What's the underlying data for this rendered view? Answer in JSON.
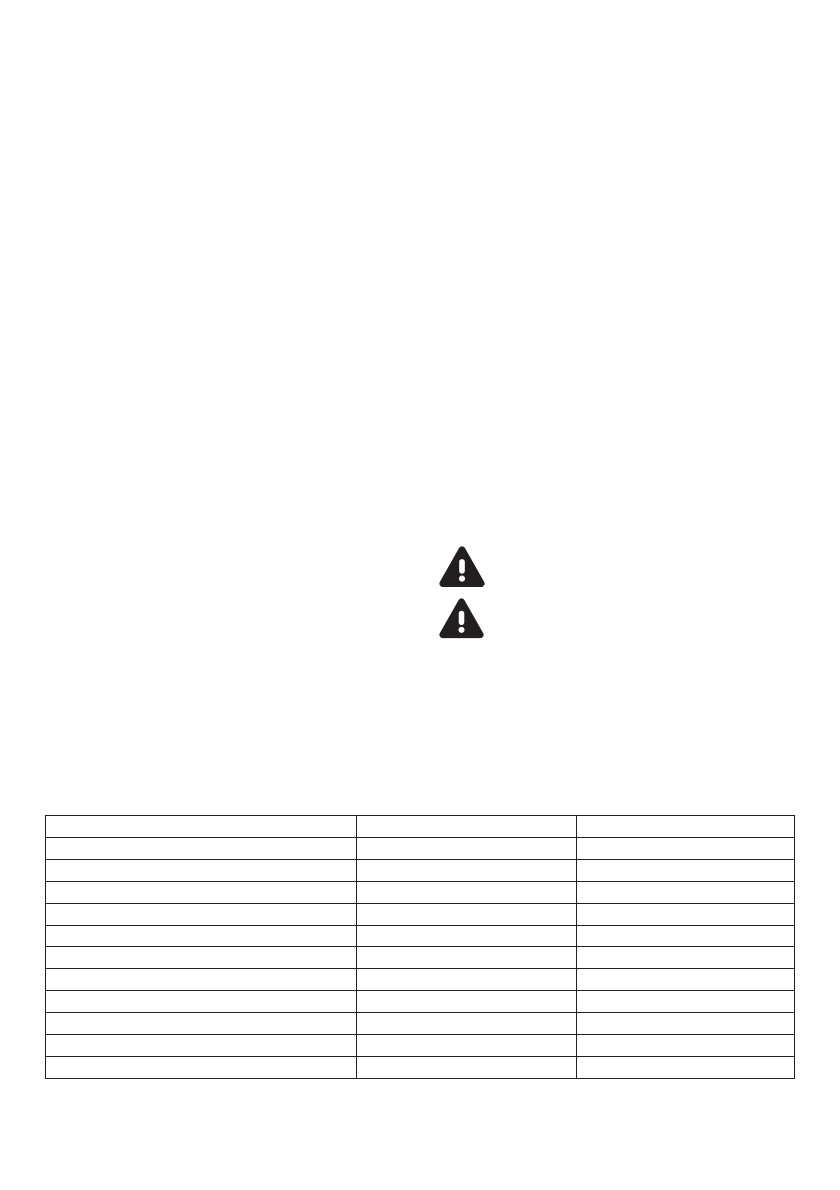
{
  "page": {
    "background": "#ffffff",
    "description": "blank-document-page"
  },
  "warning_icons": [
    {
      "name": "warning-triangle-icon",
      "symbol": "exclamation",
      "color": "#231f20"
    },
    {
      "name": "warning-triangle-icon",
      "symbol": "exclamation",
      "color": "#231f20"
    }
  ],
  "table": {
    "border_color": "#231f20",
    "rows": [
      [
        "",
        "",
        ""
      ],
      [
        "",
        "",
        ""
      ],
      [
        "",
        "",
        ""
      ],
      [
        "",
        "",
        ""
      ],
      [
        "",
        "",
        ""
      ],
      [
        "",
        "",
        ""
      ],
      [
        "",
        "",
        ""
      ],
      [
        "",
        "",
        ""
      ],
      [
        "",
        "",
        ""
      ],
      [
        "",
        "",
        ""
      ],
      [
        "",
        "",
        ""
      ],
      [
        "",
        "",
        ""
      ]
    ]
  }
}
